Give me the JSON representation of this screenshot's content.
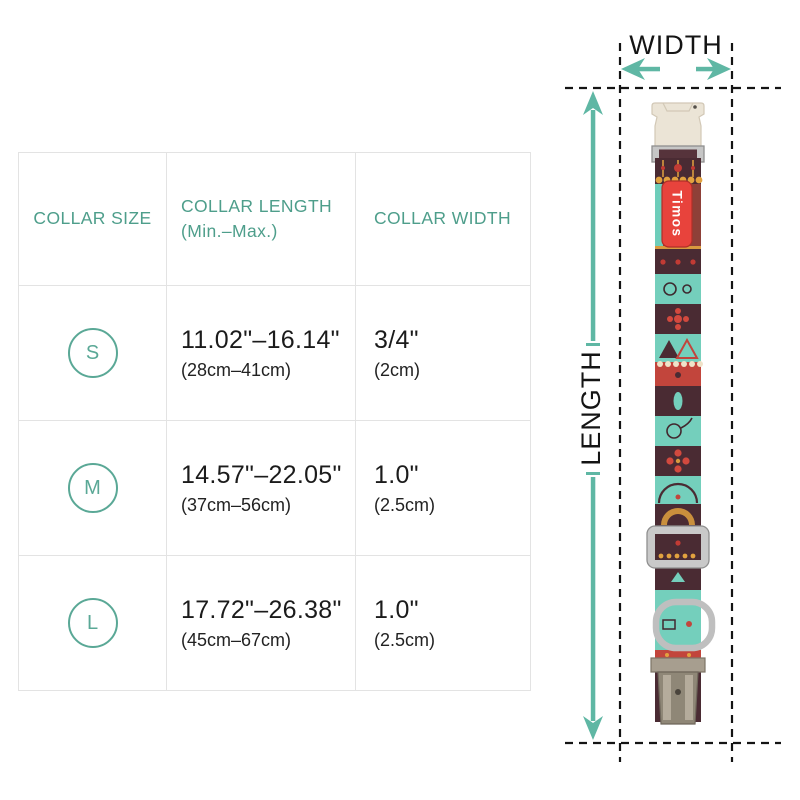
{
  "page": {
    "background": "#ffffff"
  },
  "colors": {
    "accent_teal": "#5FB7A4",
    "header_text_teal": "#4E9E8B",
    "size_circle_teal": "#5AA896",
    "body_text": "#1B1B1B",
    "guide_dash": "#141414",
    "label_red": "#E8433C",
    "strap_maroon": "#4A2B33",
    "strap_turquoise": "#74CFBC",
    "strap_gold": "#D99A3E",
    "buckle_cream": "#EBE4D6",
    "metal_silver": "#C6C6C6"
  },
  "table": {
    "columns": [
      {
        "title": "COLLAR SIZE",
        "subtitle": ""
      },
      {
        "title": "COLLAR LENGTH",
        "subtitle": "(Min.–Max.)"
      },
      {
        "title": "COLLAR WIDTH",
        "subtitle": ""
      }
    ],
    "rows": [
      {
        "size": "S",
        "length_in": "11.02\"–16.14\"",
        "length_cm": "(28cm–41cm)",
        "width_in": "3/4\"",
        "width_cm": "(2cm)"
      },
      {
        "size": "M",
        "length_in": "14.57\"–22.05\"",
        "length_cm": "(37cm–56cm)",
        "width_in": "1.0\"",
        "width_cm": "(2.5cm)"
      },
      {
        "size": "L",
        "length_in": "17.72\"–26.38\"",
        "length_cm": "(45cm–67cm)",
        "width_in": "1.0\"",
        "width_cm": "(2.5cm)"
      }
    ]
  },
  "diagram": {
    "width_label": "WIDTH",
    "length_label": "LENGTH",
    "collar_brand_label": "Timos"
  }
}
